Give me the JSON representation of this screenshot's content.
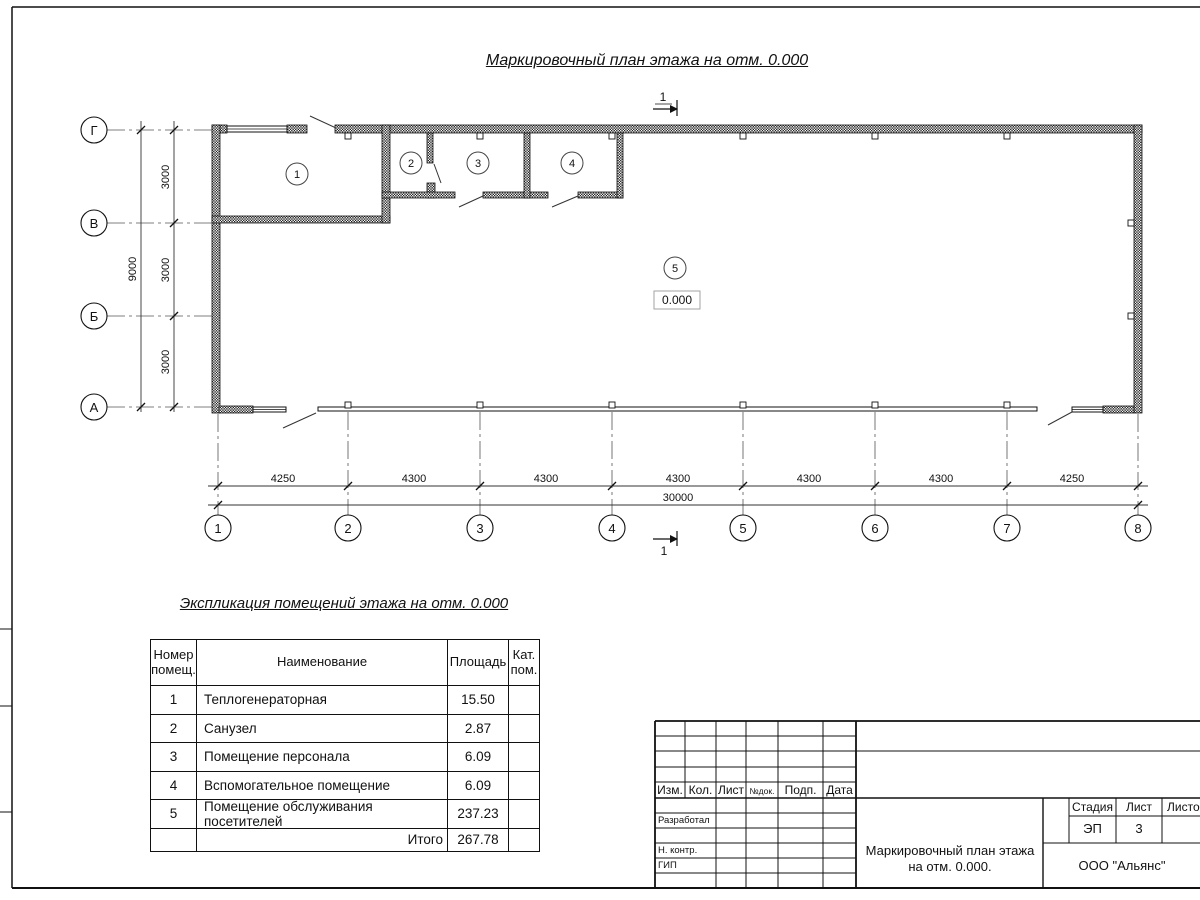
{
  "plan": {
    "title": "Маркировочный план этажа на отм. 0.000",
    "section_mark": "1",
    "elevation_mark": "0.000",
    "axes_letters": [
      "Г",
      "В",
      "Б",
      "А"
    ],
    "axes_numbers": [
      "1",
      "2",
      "3",
      "4",
      "5",
      "6",
      "7",
      "8"
    ],
    "room_numbers": [
      "1",
      "2",
      "3",
      "4",
      "5"
    ],
    "dims_vertical": [
      "3000",
      "3000",
      "3000"
    ],
    "dim_vertical_total": "9000",
    "dims_horizontal": [
      "4250",
      "4300",
      "4300",
      "4300",
      "4300",
      "4300",
      "4250"
    ],
    "dim_horizontal_total": "30000"
  },
  "explication": {
    "title": "Экспликация помещений этажа на отм. 0.000",
    "headers": {
      "number": "Номер\nпомещ.",
      "name": "Наименование",
      "area": "Площадь",
      "category": "Кат.\nпом."
    },
    "rows": [
      {
        "num": "1",
        "name": "Теплогенераторная",
        "area": "15.50",
        "cat": ""
      },
      {
        "num": "2",
        "name": "Санузел",
        "area": "2.87",
        "cat": ""
      },
      {
        "num": "3",
        "name": "Помещение персонала",
        "area": "6.09",
        "cat": ""
      },
      {
        "num": "4",
        "name": "Вспомогательное помещение",
        "area": "6.09",
        "cat": ""
      },
      {
        "num": "5",
        "name": "Помещение обслуживания посетителей",
        "area": "237.23",
        "cat": ""
      }
    ],
    "total_label": "Итого",
    "total_value": "267.78"
  },
  "titleblock": {
    "rev_headers": [
      "Изм.",
      "Кол.",
      "Лист",
      "№док.",
      "Подп.",
      "Дата"
    ],
    "roles": [
      "Разработал",
      "Н. контр.",
      "ГИП"
    ],
    "stage_label": "Стадия",
    "sheet_label": "Лист",
    "sheets_label": "Листов",
    "stage": "ЭП",
    "sheet": "3",
    "doc_title": "Маркировочный план\nэтажа на отм. 0.000.",
    "company": "ООО \"Альянс\""
  },
  "colors": {
    "line": "#111111",
    "hatch": "#1c1c1c"
  }
}
